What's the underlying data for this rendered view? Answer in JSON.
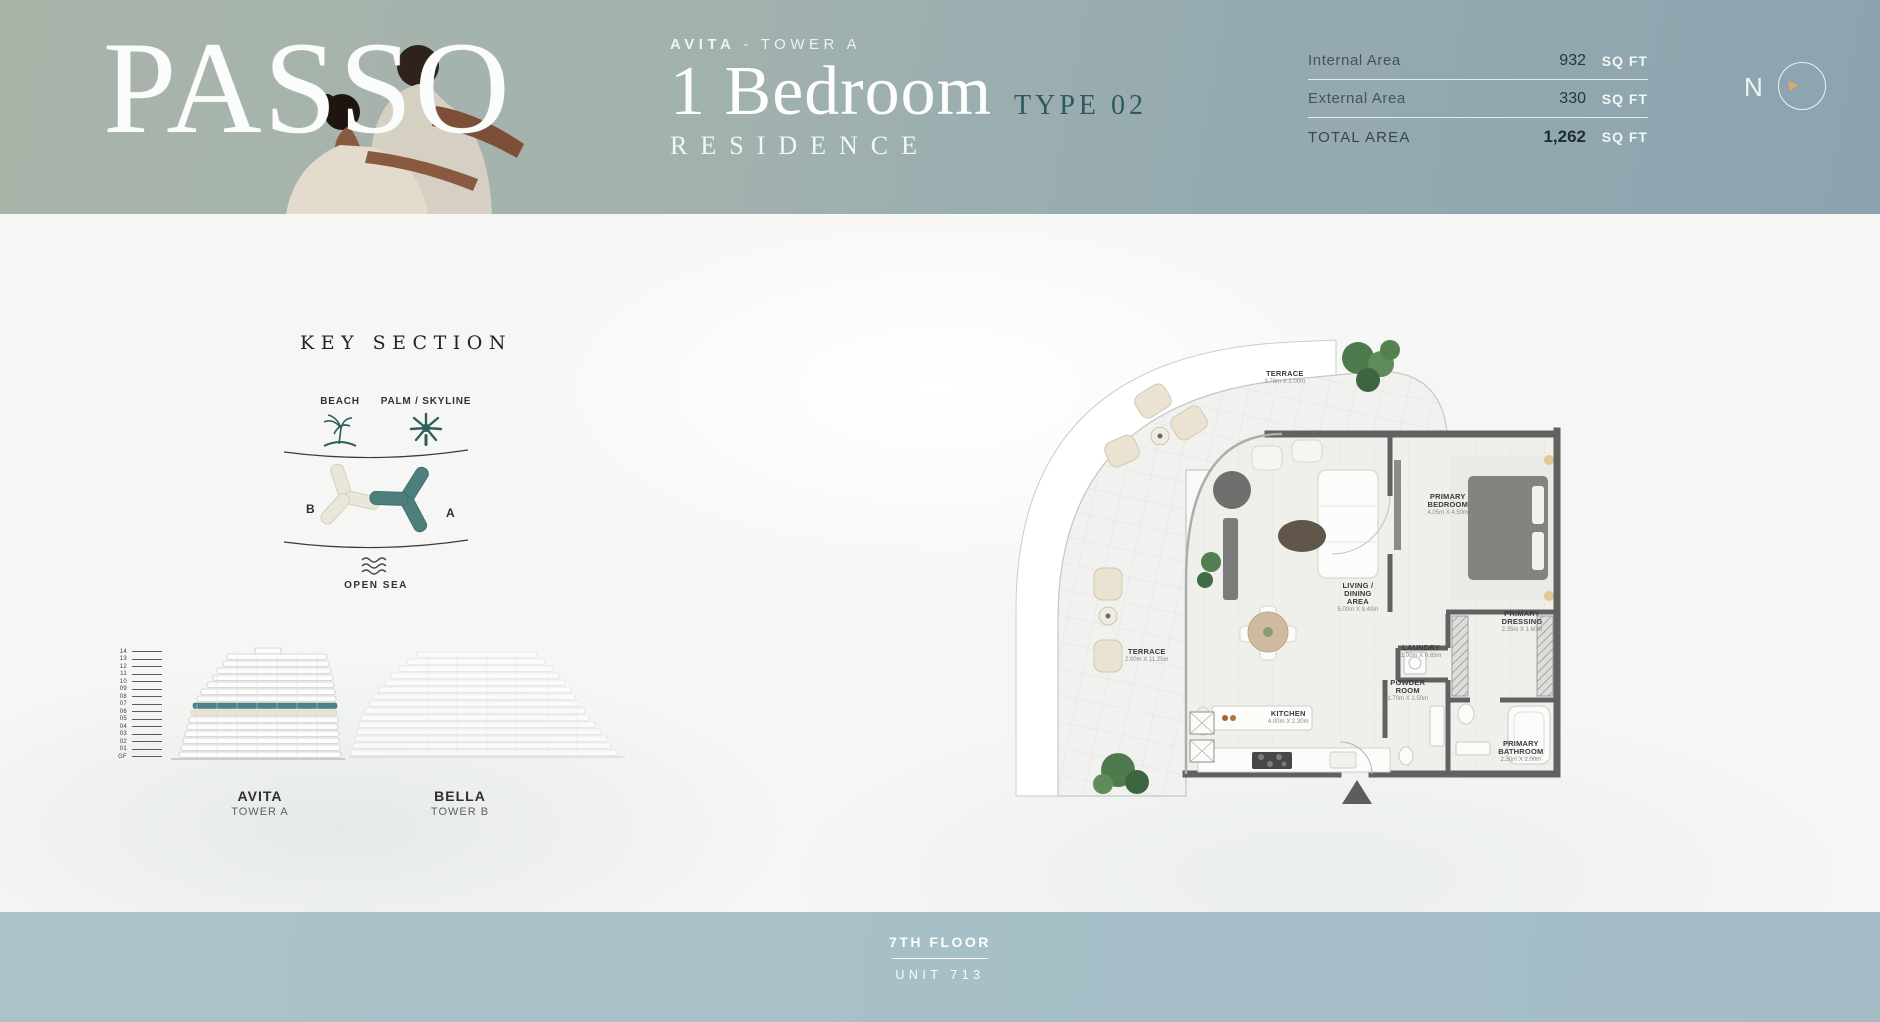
{
  "header": {
    "logo_text": "PASSO",
    "brand": "AVITA",
    "brand_sep": "-",
    "tower": "TOWER A",
    "title": "1 Bedroom",
    "type_label": "TYPE 02",
    "subtitle": "RESIDENCE",
    "area_table": {
      "rows": [
        {
          "label": "Internal Area",
          "value": "932",
          "unit": "SQ FT"
        },
        {
          "label": "External Area",
          "value": "330",
          "unit": "SQ FT"
        },
        {
          "label": "TOTAL AREA",
          "value": "1,262",
          "unit": "SQ FT"
        }
      ]
    },
    "compass_n": "N"
  },
  "key_section": {
    "title": "KEY SECTION",
    "beach_label": "BEACH",
    "palm_label": "PALM / SKYLINE",
    "open_sea_label": "OPEN SEA",
    "tower_a_letter": "A",
    "tower_b_letter": "B",
    "floors": [
      "14",
      "13",
      "12",
      "11",
      "10",
      "09",
      "08",
      "07",
      "06",
      "05",
      "04",
      "03",
      "02",
      "01",
      "GF"
    ],
    "highlighted_floor": "07",
    "towers": [
      {
        "name": "AVITA",
        "subtitle": "TOWER A"
      },
      {
        "name": "BELLA",
        "subtitle": "TOWER B"
      }
    ]
  },
  "floor_plan": {
    "rooms": [
      {
        "name": "TERRACE",
        "dims": "3.78m X 2.00m"
      },
      {
        "name": "PRIMARY BEDROOM",
        "dims": "4.05m X 4.50m"
      },
      {
        "name": "LIVING / DINING AREA",
        "dims": "5.00m X 9.40m"
      },
      {
        "name": "PRIMARY DRESSING",
        "dims": "2.35m X 1.60m"
      },
      {
        "name": "TERRACE",
        "dims": "2.00m X 11.25m"
      },
      {
        "name": "LAUNDRY",
        "dims": "1.00m X 0.85m"
      },
      {
        "name": "POWDER ROOM",
        "dims": "1.70m X 2.50m"
      },
      {
        "name": "KITCHEN",
        "dims": "4.00m X 2.30m"
      },
      {
        "name": "PRIMARY BATHROOM",
        "dims": "2.30m X 2.00m"
      }
    ]
  },
  "footer": {
    "floor_label": "7TH FLOOR",
    "unit_label": "UNIT 713"
  },
  "colors": {
    "accent_teal": "#4d7f7c",
    "dark_teal": "#2d5a60",
    "header_sage": "#aab5aa",
    "header_blue": "#8ba4af",
    "footer_blue": "#a7c0c8",
    "tower_b_beige": "#eae7da",
    "compass_orange": "#dcaa6b"
  }
}
